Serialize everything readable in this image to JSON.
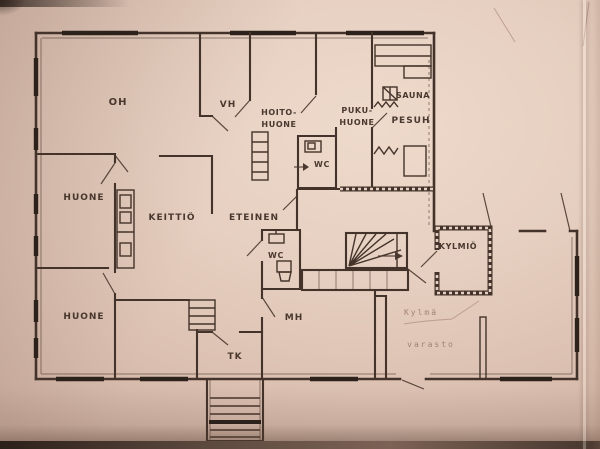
{
  "photo": {
    "description": "floor plan drawing photographed on pinkish paper",
    "paper_color": "#e6cfc0",
    "ink_color": "#44332a",
    "faint_ink_color": "#967767"
  },
  "rooms": {
    "oh": {
      "label": "OH"
    },
    "vh": {
      "label": "VH"
    },
    "hoitohuone": {
      "line1": "HOITO-",
      "line2": "HUONE"
    },
    "pukuhuone": {
      "line1": "PUKU-",
      "line2": "HUONE"
    },
    "sauna": {
      "label": "SAUNA"
    },
    "pesuhuone": {
      "label": "PESUH"
    },
    "wc_upper": {
      "label": "WC"
    },
    "wc_lower": {
      "label": "WC"
    },
    "huone_middle": {
      "label": "HUONE"
    },
    "huone_lower": {
      "label": "HUONE"
    },
    "keittio": {
      "label": "KEITTIÖ"
    },
    "eteinen": {
      "label": "ETEINEN"
    },
    "mh": {
      "label": "MH"
    },
    "tk": {
      "label": "TK"
    },
    "kylmio": {
      "label": "KYLMIÖ"
    },
    "kylma_varasto": {
      "line1": "Kylmä",
      "line2": "varasto"
    }
  }
}
